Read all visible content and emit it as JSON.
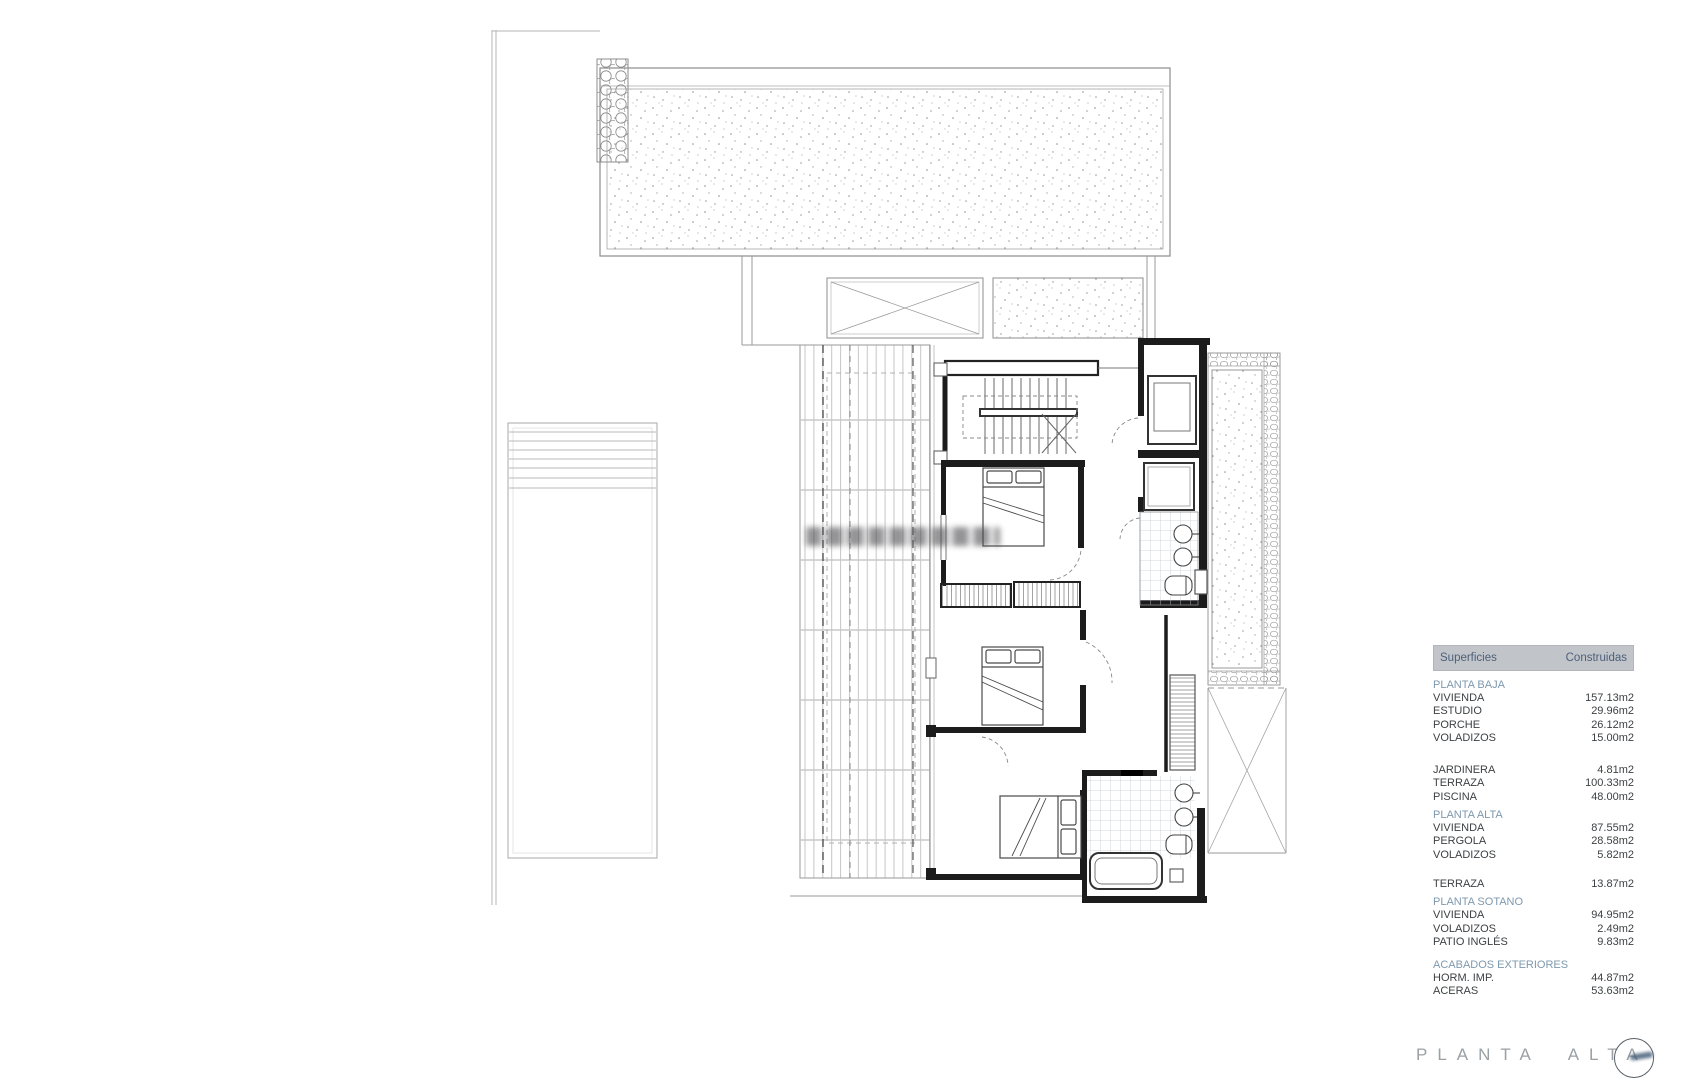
{
  "colors": {
    "table_header_bg": "#c1c5c9",
    "table_header_text": "#4e5f7b",
    "section_title_text": "#7e99ae",
    "table_body_text": "#3d4144",
    "sheet_title_text": "#9ba0a4",
    "wall_line": "#1c1c1c"
  },
  "table": {
    "header": {
      "superficies": "Superficies",
      "construidas": "Construidas"
    },
    "sections": [
      {
        "title": "PLANTA BAJA",
        "rows": [
          {
            "label": "VIVIENDA",
            "value": "157.13m2"
          },
          {
            "label": "ESTUDIO",
            "value": "29.96m2"
          },
          {
            "label": "PORCHE",
            "value": "26.12m2"
          },
          {
            "label": "VOLADIZOS",
            "value": "15.00m2"
          }
        ]
      },
      {
        "title": "",
        "rows": [
          {
            "label": "JARDINERA",
            "value": "4.81m2"
          },
          {
            "label": "TERRAZA",
            "value": "100.33m2"
          },
          {
            "label": "PISCINA",
            "value": "48.00m2"
          }
        ]
      },
      {
        "title": "PLANTA ALTA",
        "rows": [
          {
            "label": "VIVIENDA",
            "value": "87.55m2"
          },
          {
            "label": "PERGOLA",
            "value": "28.58m2"
          },
          {
            "label": "VOLADIZOS",
            "value": "5.82m2"
          }
        ]
      },
      {
        "title": "",
        "rows": [
          {
            "label": "TERRAZA",
            "value": "13.87m2"
          }
        ]
      },
      {
        "title": "PLANTA SOTANO",
        "rows": [
          {
            "label": "VIVIENDA",
            "value": "94.95m2"
          },
          {
            "label": "VOLADIZOS",
            "value": "2.49m2"
          },
          {
            "label": "PATIO INGLÉS",
            "value": "9.83m2"
          }
        ]
      },
      {
        "title": "ACABADOS EXTERIORES",
        "rows": [
          {
            "label": "HORM. IMP.",
            "value": "44.87m2"
          },
          {
            "label": "ACERAS",
            "value": "53.63m2"
          }
        ]
      }
    ]
  },
  "footer": {
    "sheet_title": "PLANTA ALTA",
    "logo_icon": "architect-stamp-icon"
  }
}
